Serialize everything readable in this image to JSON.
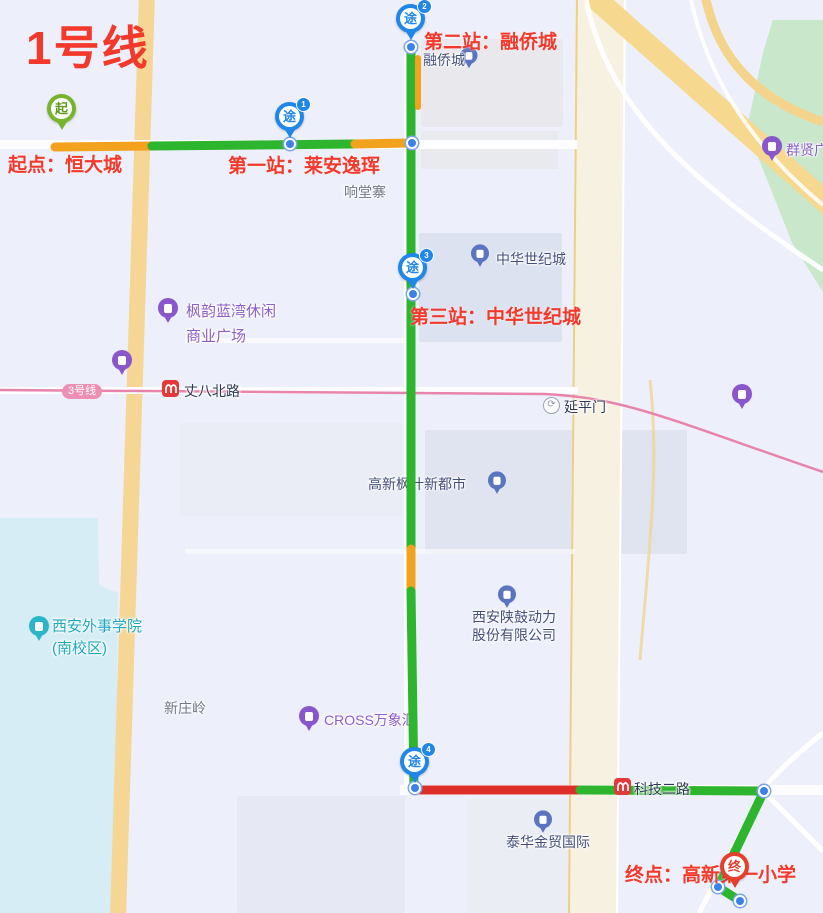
{
  "title": "1号线",
  "colors": {
    "annotation_red": "#f2392c",
    "route_green": "#2db52d",
    "route_slow_orange": "#f2a21d",
    "route_congested_red": "#dd2f28",
    "start_pin_green": "#76b52b",
    "waypoint_pin_blue": "#1f86ea",
    "end_pin_red": "#e5402e",
    "metro_line_pink": "#e884ab"
  },
  "route": {
    "start": {
      "label": "起点：恒大城",
      "pin_glyph": "起"
    },
    "end": {
      "label": "终点：高新第一小学",
      "pin_glyph": "终"
    },
    "waypoints": [
      {
        "number": "1",
        "label": "第一站：莱安逸珲",
        "pin_glyph": "途"
      },
      {
        "number": "2",
        "label": "第二站：融侨城",
        "pin_glyph": "途"
      },
      {
        "number": "3",
        "label": "第三站：中华世纪城",
        "pin_glyph": "途"
      },
      {
        "number": "4",
        "label": "",
        "pin_glyph": "途"
      }
    ]
  },
  "metro": {
    "line_badge": "3号线",
    "station_zhangba": "丈八北路",
    "station_keji": "科技二路",
    "landmark_yanpingmen": "延平门"
  },
  "pois": {
    "rongqiaocheng": "融侨城",
    "xiangtangzhai": "响堂寨",
    "zhonghua_century": "中华世纪城",
    "fengyun_line1": "枫韵蓝湾休闲",
    "fengyun_line2": "商业广场",
    "gaoxin_fengye": "高新枫叶新都市",
    "waishi_line1": "西安外事学院",
    "waishi_line2": "(南校区)",
    "xinzhuangling": "新庄岭",
    "cross_mall": "CROSS万象汇",
    "shaangu_line1": "西安陕鼓动力",
    "shaangu_line2": "股份有限公司",
    "taihua": "泰华金贸国际",
    "qunxian": "群贤广场"
  }
}
